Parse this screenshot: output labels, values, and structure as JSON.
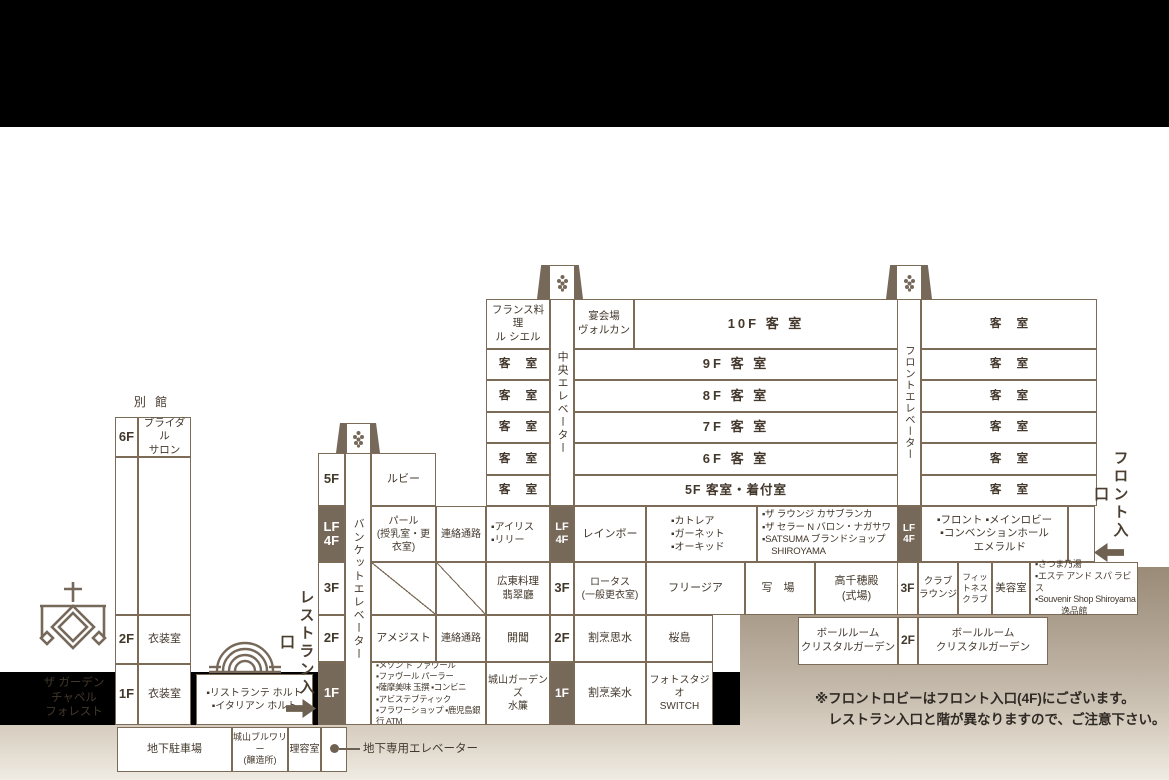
{
  "colors": {
    "dark_cell": "#77695a",
    "border": "#7c6b57",
    "text": "#43382c",
    "ground_top": "#9a8b77",
    "ground_bottom": "#faf9f6",
    "background_bars": "#000000"
  },
  "icons": {
    "crest": "hotel-crest-icon",
    "chapel": "chapel-icon",
    "arch": "arch-building-icon",
    "restaurant_arrow": "right-arrow",
    "front_arrow": "left-arrow",
    "basement_dot": "dot-marker"
  },
  "annex": {
    "title": "別 館",
    "f6": {
      "floor": "6F",
      "label": "ブライダル\nサロン"
    },
    "f2": {
      "floor": "2F",
      "label": "衣装室"
    },
    "f1": {
      "floor": "1F",
      "label": "衣装室"
    }
  },
  "chapel": {
    "label": "ザ ガーデン\nチャペル\nフォレスト"
  },
  "holt": {
    "label": "▪リストランテ ホルト\n▪イタリアン ホルト"
  },
  "entrances": {
    "restaurant": "レストラン入口",
    "front": "フロント入口"
  },
  "banquet": {
    "elevator": "バンケットエレベーター",
    "floors": {
      "f5": "5F",
      "lf4f": "LF\n4F",
      "f3": "3F",
      "f2": "2F",
      "f1": "1F"
    },
    "f5": {
      "ruby": "ルビー"
    },
    "lf4f": {
      "pearl": "パール\n(授乳室・更衣室)",
      "corridor": "連絡通路"
    },
    "f2": {
      "amethyst": "アメジスト",
      "corridor": "連絡通路"
    },
    "f1": {
      "shops": "▪メゾン ド ファヴール\n▪ファヴール パーラー\n▪薩摩美味 玉撰 ▪コンビニ\n▪アビステブティック\n▪フラワーショップ ▪鹿児島銀行 ATM"
    }
  },
  "center": {
    "elevator": "中央エレベーター",
    "floors": {
      "lf4f": "LF\n4F",
      "f3": "3F",
      "f2": "2F",
      "f1": "1F"
    },
    "f10_left": "フランス料理\nル シエル",
    "left_rooms": [
      "客 室",
      "客 室",
      "客 室",
      "客 室",
      "客 室"
    ],
    "banquet_hall": "宴会場\nヴォルカン",
    "floor_rows": [
      "10F 客 室",
      "9F 客 室",
      "8F 客 室",
      "7F 客 室",
      "6F 客 室",
      "5F 客室・着付室"
    ],
    "lf4f": {
      "iris": "▪アイリス\n▪リリー",
      "rainbow": "レインボー",
      "flowers": "▪カトレア\n▪ガーネット\n▪オーキッド",
      "lounge": "▪ザ ラウンジ カサブランカ\n▪ザ セラー N バロン・ナガサワ\n▪SATSUMA ブランドショップ\n　SHIROYAMA"
    },
    "f3": {
      "cantonese": "広東料理\n翡翠廳",
      "lotus": "ロータス\n(一般更衣室)",
      "freesia": "フリージア",
      "photo": "写 場",
      "takachiho": "高千穂殿\n(式場)"
    },
    "f2": {
      "kaimon": "開聞",
      "shisui": "割烹思水",
      "sakurajima": "桜島"
    },
    "f1": {
      "suiren": "城山ガーデンズ\n水簾",
      "rakusui": "割烹楽水",
      "photo_studio": "フォトスタジオ\nSWITCH"
    }
  },
  "front": {
    "elevator": "フロントエレベーター",
    "floors": {
      "lf4f": "LF\n4F",
      "f3": "3F",
      "f2": "2F"
    },
    "rooms": [
      "客 室",
      "客 室",
      "客 室",
      "客 室",
      "客 室",
      "客 室"
    ],
    "lf4f": {
      "lobby": "▪フロント ▪メインロビー\n▪コンベンションホール\n　エメラルド"
    },
    "f3": {
      "club_lounge": "クラブ\nラウンジ",
      "fitness": "フィットネス\nクラブ",
      "beauty": "美容室",
      "spa_list": "▪さつま乃湯\n▪エステ アンド スパ ラビス\n▪Souvenir Shop Shiroyama\n　　　逸品館"
    },
    "f2": {
      "ballroom_left": "ボールルーム\nクリスタルガーデン",
      "ballroom_right": "ボールルーム\nクリスタルガーデン"
    }
  },
  "basement": {
    "parking": "地下駐車場",
    "brewery": "城山ブルワリー\n(醸造所)",
    "barber": "理容室",
    "elevator_note": "地下専用エレベーター"
  },
  "note": {
    "text": "※フロントロビーはフロント入口(4F)にございます。\n　レストラン入口と階が異なりますので、ご注意下さい。"
  }
}
